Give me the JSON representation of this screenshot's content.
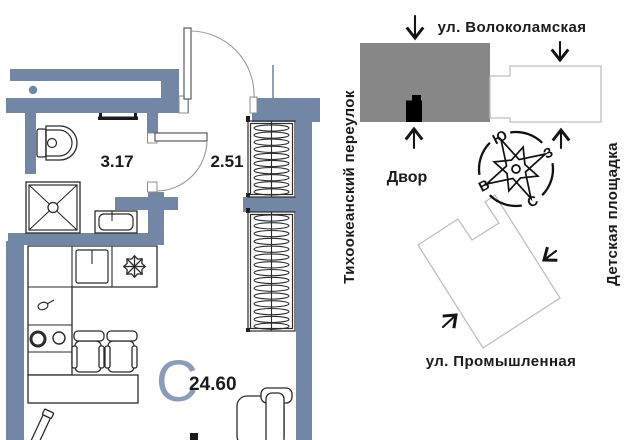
{
  "floorplan": {
    "bath_area": "3.17",
    "hall_area": "2.51",
    "type_letter": "С",
    "total_area": "24.60"
  },
  "siteplan": {
    "street_top": "ул. Волоколамская",
    "street_left": "Тихоокеанский переулок",
    "street_bottom": "ул. Промышленная",
    "playground": "Детская площадка",
    "courtyard": "Двор",
    "compass": {
      "south": "Ю",
      "west": "З",
      "north": "С",
      "east": "В"
    }
  },
  "colors": {
    "wall": "#7287a5",
    "gray_building": "#878787",
    "marker": "#000000",
    "type_letter_color": "#8a9cb7",
    "outline": "#bfbfbf",
    "text": "#1b1b1b"
  }
}
